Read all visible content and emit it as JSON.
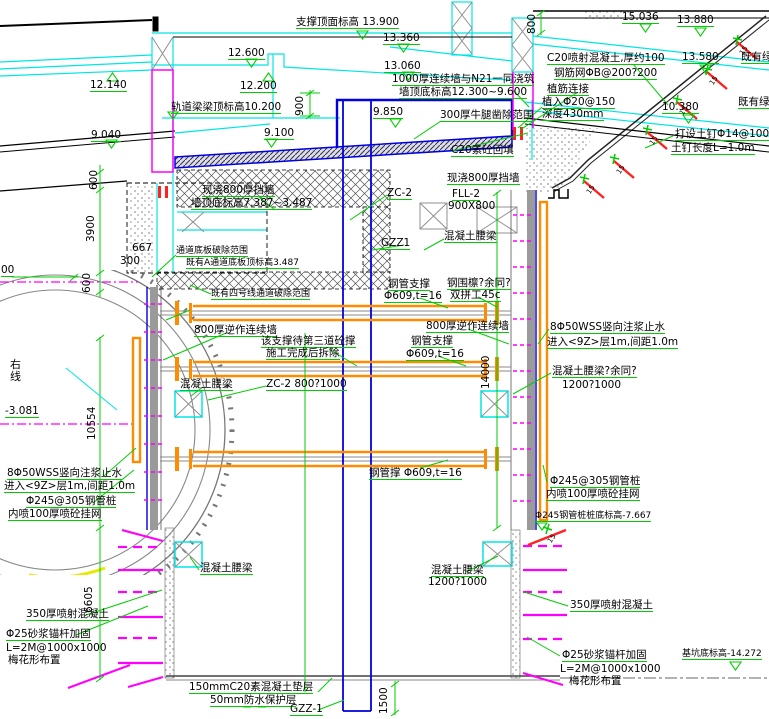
{
  "drawing_type": "基坑支护横断面图",
  "colors": {
    "existing_cyan": "#00E5E5",
    "structure_blue": "#0000E0",
    "new_work_magenta": "#FF00FF",
    "dimension_green": "#00CC00",
    "steel_orange": "#FF8C00",
    "rebar_red": "#FF2222"
  },
  "labels": {
    "support_top_elev": "支撑顶面标高 13.900",
    "elev_13_360": "13.360",
    "elev_12_600": "12.600",
    "elev_13_060": "13.060",
    "elev_12_140": "12.140",
    "elev_12_200": "12.200",
    "elev_9_850": "9.850",
    "elev_9_040": "9.040",
    "elev_9_100": "9.100",
    "elev_15_036": "15.036",
    "elev_13_880": "13.880",
    "elev_13_580": "13.580",
    "elev_10_380": "10.380",
    "elev_neg_3_081": "-3.081",
    "diaphragm_note_1": "1000厚连续墙与N21一同浇筑",
    "diaphragm_note_2": "墙顶底标高12.300~9.600",
    "rail_beam_elev": "轨道梁梁顶标高10.200",
    "shotcrete_note_1": "C20喷射混凝土,厚约100",
    "shotcrete_note_2": "钢筋网ΦB@200?200",
    "rebar_connect": "植筋连接",
    "rebar_embed_1": "植入Φ20@150",
    "rebar_embed_2": "深度430mm",
    "soil_nail_1": "打设土钉Φ14@1000",
    "soil_nail_2": "土钉长度L=1.0m",
    "existing_green": "既有绿化",
    "corbel_removal": "300厚牛腿凿除范围",
    "c20_backfill": "C20素砼回填",
    "cast_wall_800": "现浇800厚挡墙",
    "cast_wall_800_elev": "墙顶底标高7.387~3.487",
    "passage_removal": "通道底板破除范围",
    "passage_slab_elev": "既有A通道底板顶标高3.487",
    "line4_removal": "既有四号线通道破除范围",
    "zc2": "ZC-2",
    "zc2_size": "ZC-2 800?1000",
    "fll2": "FLL-2",
    "fll2_size": "900X800",
    "gzz1": "GZZ1",
    "gzz1_bottom": "GZZ-1",
    "concrete_waler": "混凝土腰梁",
    "concrete_waler_rest": "混凝土腰梁?余同?",
    "waler_size": "1200?1000",
    "steel_strut": "钢管支撑",
    "steel_strut_spec": "Φ609,t=16",
    "steel_strut_3": "钢管撑 Φ609,t=16",
    "steel_waler_1": "钢围檩?余同?",
    "steel_waler_2": "双拼工45c",
    "wall_800_reverse": "800厚逆作连续墙",
    "strut_removal_1": "该支撑待第三道砼撑",
    "strut_removal_2": "施工完成后拆除",
    "right_line": "右线",
    "wss_1": "8Φ50WSS竖向注浆止水",
    "wss_2": "进入<9Z>层1m,间距1.0m",
    "pipe_pile_1": "Φ245@305钢管桩",
    "pipe_pile_2": "内喷100厚喷砼挂网",
    "pipe_pile_bottom": "Φ245钢管桩桩底标高-7.667",
    "shotcrete_350": "350厚喷射混凝土",
    "anchor_1": "Φ25砂浆锚杆加固",
    "anchor_2": "L=2M@1000x1000",
    "anchor_3": "梅花形布置",
    "pit_bottom_elev": "基坑底标高-14.272",
    "cushion_1": "150mmC20素混凝土垫层",
    "cushion_2": "50mm防水保护层",
    "slope_angle": "15"
  },
  "dimensions": {
    "d900": "900",
    "d800": "800",
    "d600": "600",
    "d3900": "3900",
    "d667": "667",
    "d300": "300",
    "d00": "00",
    "d10554": "10554",
    "d6605": "6605",
    "d14000": "14000",
    "d1500": "1500"
  }
}
